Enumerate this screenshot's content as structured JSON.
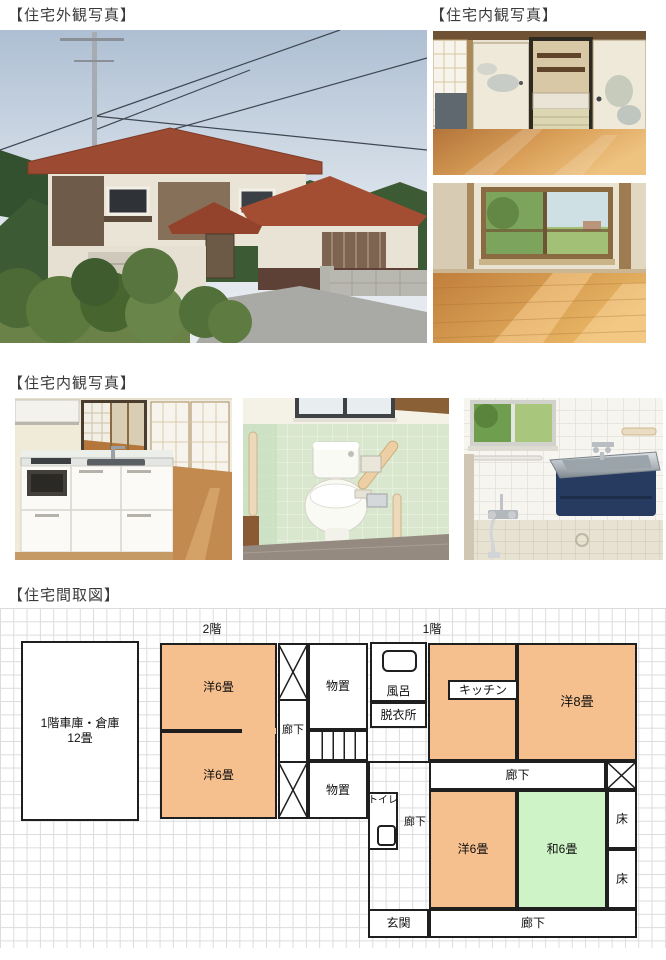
{
  "labels": {
    "exterior_section": "【住宅外観写真】",
    "interior_top_section": "【住宅内観写真】",
    "interior_mid_section": "【住宅内観写真】",
    "floorplan_section": "【住宅間取図】"
  },
  "floorplan": {
    "floor2": "2階",
    "floor1": "1階",
    "garage_line1": "1階車庫・倉庫",
    "garage_line2": "12畳",
    "western6_a": "洋6畳",
    "western6_b": "洋6畳",
    "western6_c": "洋6畳",
    "western8": "洋8畳",
    "japanese6": "和6畳",
    "storage_a": "物置",
    "storage_b": "物置",
    "corridor_2f": "廊下",
    "corridor_1f_side": "廊下",
    "corridor_1f_top": "廊下",
    "corridor_1f_bottom": "廊下",
    "bath": "風呂",
    "dressing": "脱衣所",
    "kitchen": "キッチン",
    "toilet": "トイレ",
    "alcove_a": "床",
    "alcove_b": "床",
    "entrance": "玄関"
  },
  "photo_alts": {
    "exterior_main": "two-story house with red tiled roof",
    "interior_tatami": "wood-floor room with fusuma and tatami room beyond",
    "interior_western": "wood-floor room with window to fields",
    "kitchen": "white kitchen counter with sink",
    "toilet": "toilet with pale green tile walls",
    "bathroom": "bathroom with stainless tub in navy surround"
  },
  "colors": {
    "room_orange": "#F6BF8E",
    "room_green": "#CEF3C6",
    "wall_line": "#1F1F1F",
    "grid_line": "#DCDCDC"
  }
}
